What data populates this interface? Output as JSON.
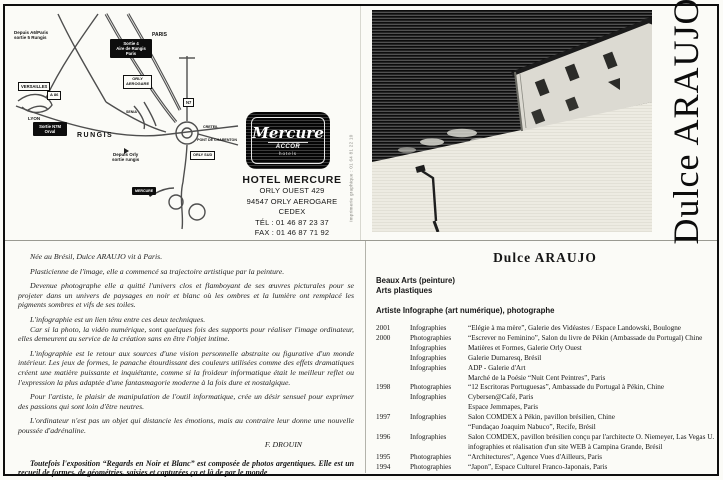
{
  "artist": {
    "vertical_name": "Dulce ARAUJO"
  },
  "hotel": {
    "logo_brand": "Mercure",
    "logo_accor": "ACCOR",
    "logo_hotels": "hotels",
    "name": "HOTEL MERCURE",
    "address1": "ORLY OUEST 429",
    "address2": "94547 ORLY AEROGARE CEDEX",
    "tel": "TÉL : 01 46 87 23 37",
    "fax": "FAX : 01 46 87 71 92"
  },
  "print_credit": "imprimerie graphique : 01 64 81 22 10",
  "map": {
    "labels": [
      "Depuis A6/Paris\nsortie 5 Rungis",
      "PARIS",
      "Sortie 4\nAire de Rungis\nParis",
      "ORLY\nAEROGARE",
      "VERSAILLES",
      "A 86",
      "LYON",
      "Sortie N7M\nOrval",
      "RUNGIS",
      "SENIA",
      "Depuis Orly\nsortie rungis",
      "N7",
      "CRETEIL",
      "PONT DE CHARENTON",
      "ORLY SUD",
      "MERCURE"
    ]
  },
  "bio": {
    "paragraphs": [
      "Née au Brésil, Dulce ARAUJO vit à Paris.",
      "Plasticienne de l'image, elle a commencé sa trajectoire artistique par la peinture.",
      "Devenue photographe elle a quitté l'univers clos et flamboyant de ses œuvres picturales pour se projeter dans un univers de paysages en noir et blanc où les ombres et la lumière ont remplacé les pigments sombres et vifs de ses toiles.",
      "L'infographie est un lien ténu entre ces deux techniques.",
      "Car si la photo, la vidéo numérique, sont quelques fois des supports pour réaliser l'image ordinateur, elles demeurent au service de la création sans en être l'objet intime.",
      "L'infographie est le retour aux sources d'une vision personnelle abstraite ou figurative d'un monde intérieur. Les jeux de formes, le panache étourdissant des couleurs utilisées comme des effets dramatiques créent une matière puissante et inquiétante, comme si la froideur informatique était le meilleur reflet ou l'expression la plus adaptée d'une fantasmagorie moderne à la fois dure et nostalgique.",
      "Pour l'artiste, le plaisir de manipulation de l'outil informatique, crée un désir sensuel pour exprimer des passions qui sont loin d'être neutres.",
      "L'ordinateur n'est pas un objet qui distancie les émotions, mais au contraire leur donne une nouvelle poussée d'adrénaline."
    ],
    "signature": "F. DROUIN",
    "footnote": "Toutefois l'exposition “Regards en Noir et Blanc” est composée de photos argentiques. Elle est un recueil de formes, de géométries, saisies et capturées ça et là de par le monde"
  },
  "cv": {
    "title": "Dulce ARAUJO",
    "head1": "Beaux Arts (peinture)",
    "head2": "Arts plastiques",
    "role": "Artiste Infographe (art numérique), photographe",
    "rows": [
      {
        "year": "2001",
        "type": "Infographies",
        "desc": "“Elégie à ma mère”, Galerie des Vidéastes / Espace Landowski, Boulogne"
      },
      {
        "year": "2000",
        "type": "Photographies",
        "desc": "“Escrever no Feminino”, Salon du livre de Pékin (Ambassade du Portugal) Chine"
      },
      {
        "year": "",
        "type": "Infographies",
        "desc": "Matières et Formes, Galerie Orly Ouest"
      },
      {
        "year": "",
        "type": "Infographies",
        "desc": "Galerie Dumaresq, Brésil"
      },
      {
        "year": "",
        "type": "Infographies",
        "desc": "ADP - Galerie d'Art"
      },
      {
        "year": "",
        "type": "",
        "desc": "Marché de la Poésie “Nuit Cent Peintres”, Paris"
      },
      {
        "year": "1998",
        "type": "Photographies",
        "desc": "“12 Escritoras Portuguesas”, Ambassade du Portugal à Pékin, Chine"
      },
      {
        "year": "",
        "type": "Infographies",
        "desc": "Cybersen@Café, Paris"
      },
      {
        "year": "",
        "type": "",
        "desc": "Espace Jemmapes, Paris"
      },
      {
        "year": "1997",
        "type": "Infographies",
        "desc": "Salon COMDEX à Pékin, pavillon brésilien, Chine"
      },
      {
        "year": "",
        "type": "",
        "desc": "“Fundaçao Joaquim Nabuco”, Recife, Brésil"
      },
      {
        "year": "1996",
        "type": "Infographies",
        "desc": "Salon COMDEX, pavillon brésilien conçu par l'architecte O. Niemeyer, Las Vegas U.S.A"
      },
      {
        "year": "",
        "type": "",
        "desc": "infographies et réalisation d'un site WEB à Campina Grande, Brésil"
      },
      {
        "year": "1995",
        "type": "Photographies",
        "desc": "“Architectures”, Agence Vues d'Ailleurs, Paris"
      },
      {
        "year": "1994",
        "type": "Photographies",
        "desc": "“Japon”, Espace Culturel Franco-Japonais, Paris"
      }
    ]
  }
}
